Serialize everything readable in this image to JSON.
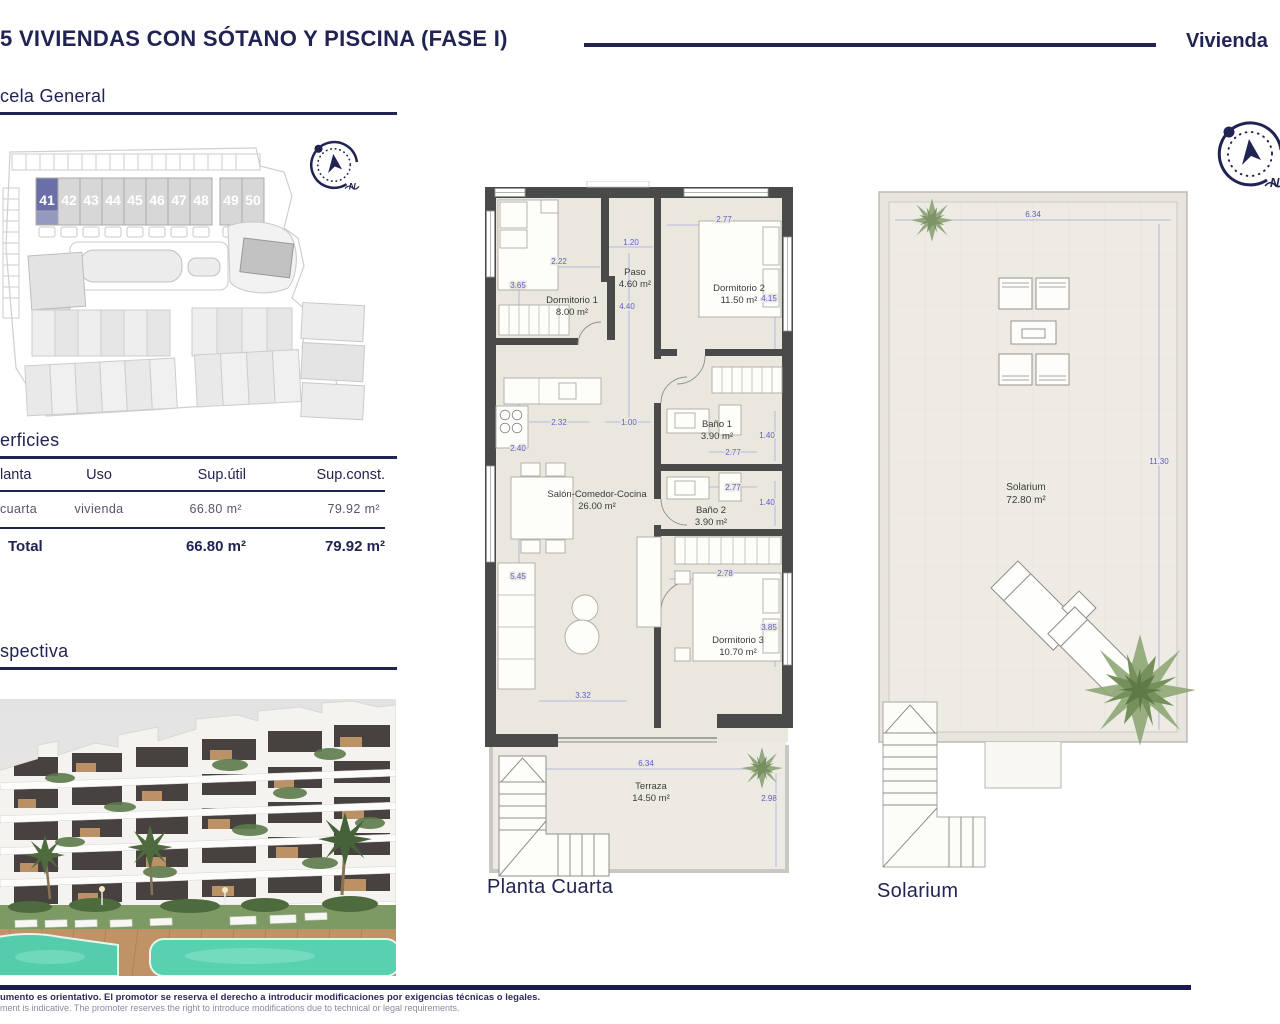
{
  "header": {
    "title": "5 VIVIENDAS CON SÓTANO Y PISCINA (FASE I)",
    "right_label": "Vivienda"
  },
  "sections": {
    "parcela_title": "cela General",
    "superficies_title": "erficies",
    "perspectiva_title": "spectiva"
  },
  "compass": {
    "north_label": "N"
  },
  "site_plan": {
    "units": [
      "41",
      "42",
      "43",
      "44",
      "45",
      "46",
      "47",
      "48",
      "49",
      "50"
    ],
    "highlighted_unit": "41"
  },
  "surfaces_table": {
    "headers": [
      "lanta",
      "Uso",
      "Sup.útil",
      "Sup.const."
    ],
    "row": {
      "planta": "cuarta",
      "uso": "vivienda",
      "sup_util": "66.80 m²",
      "sup_const": "79.92 m²"
    },
    "total": {
      "label": "Total",
      "sup_util": "66.80 m²",
      "sup_const": "79.92 m²"
    }
  },
  "floor_plan": {
    "caption": "Planta Cuarta",
    "rooms": [
      {
        "name": "Dormitorio 1",
        "area": "8.00 m²"
      },
      {
        "name": "Paso",
        "area": "4.60 m²"
      },
      {
        "name": "Dormitorio 2",
        "area": "11.50 m²"
      },
      {
        "name": "Baño 1",
        "area": "3.90 m²"
      },
      {
        "name": "Salón-Comedor-Cocina",
        "area": "26.00 m²"
      },
      {
        "name": "Baño 2",
        "area": "3.90 m²"
      },
      {
        "name": "Dormitorio 3",
        "area": "10.70 m²"
      },
      {
        "name": "Terraza",
        "area": "14.50 m²"
      }
    ],
    "dims": {
      "dorm1_width": "2.22",
      "dorm1_height": "3.65",
      "paso_width": "1.20",
      "paso_height": "4.40",
      "dorm2_width": "2.77",
      "dorm2_height": "4.15",
      "bano1_width": "2.77",
      "bano1_height": "1.40",
      "bano2_width": "2.77",
      "bano2_height": "1.40",
      "kitchen_width": "2.32",
      "kitchen_height": "2.40",
      "hall_width": "1.00",
      "salon_height": "5.45",
      "salon_width": "3.32",
      "dorm3_width": "2.78",
      "dorm3_height": "3.85",
      "terraza_width": "6.34",
      "terraza_height": "2.98"
    }
  },
  "solarium_plan": {
    "caption": "Solarium",
    "room": {
      "name": "Solarium",
      "area": "72.80 m²"
    },
    "dims": {
      "width": "6.34",
      "height": "11.30"
    }
  },
  "footer": {
    "disclaimer_es": "umento es orientativo. El promotor se reserva el derecho a introducir modificaciones por exigencias técnicas o legales.",
    "disclaimer_en": "ment is indicative. The promoter reserves the right to introduce modifications due to technical or legal requirements."
  },
  "colors": {
    "navy": "#212453",
    "dimension_blue": "#5f5fc8",
    "wall": "#4a4a4a",
    "floor": "#eae7df",
    "unit_highlight": "#6a6fa8",
    "unit_gray": "#d7d7d7",
    "pool": "#57cfae"
  }
}
